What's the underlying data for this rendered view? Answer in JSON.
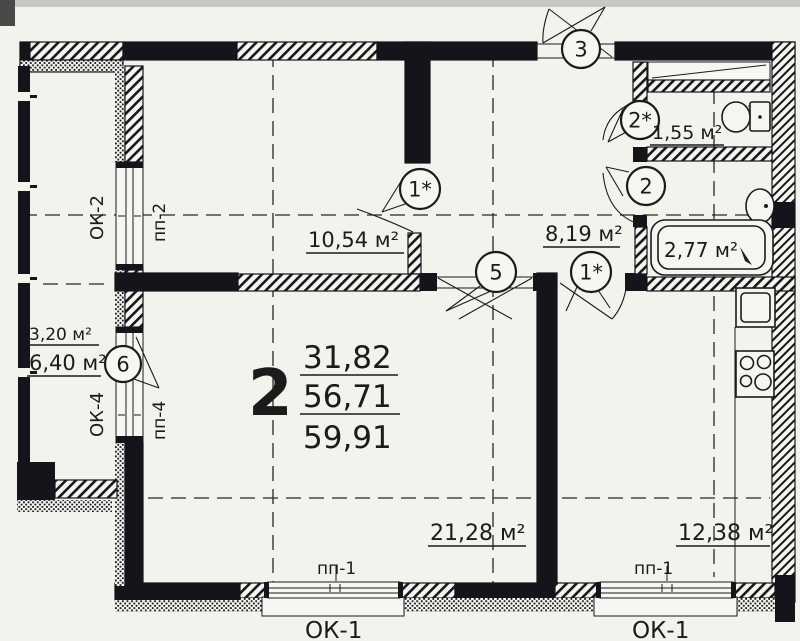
{
  "colors": {
    "paper": "#f3f2ed",
    "ink": "#1b1b1b"
  },
  "apartment": {
    "number": "2",
    "living_area": "31,82",
    "heated_area": "56,71",
    "total_area": "59,91"
  },
  "rooms": {
    "bedroom": {
      "area": "10,54 м²"
    },
    "hall": {
      "area": "8,19 м²"
    },
    "wc": {
      "area": "1,55 м²"
    },
    "bathroom": {
      "area": "2,77 м²"
    },
    "living": {
      "area": "21,28 м²"
    },
    "kitchen": {
      "area": "12,38 м²"
    },
    "balcony": {
      "area_reduced": "3,20 м²",
      "area_full": "6,40 м²"
    }
  },
  "door_marks": {
    "entrance": "3",
    "wc": "2*",
    "bathroom": "2",
    "bedroom": "1*",
    "living": "5",
    "kitchen": "1*",
    "balcony": "6"
  },
  "window_labels": {
    "ok1_left": "ОК-1",
    "ok1_right": "ОК-1",
    "pp1_left": "пп-1",
    "pp1_right": "пп-1",
    "ok2": "ОК-2",
    "pp2": "пп-2",
    "ok4": "ОК-4",
    "pp4": "пп-4"
  }
}
